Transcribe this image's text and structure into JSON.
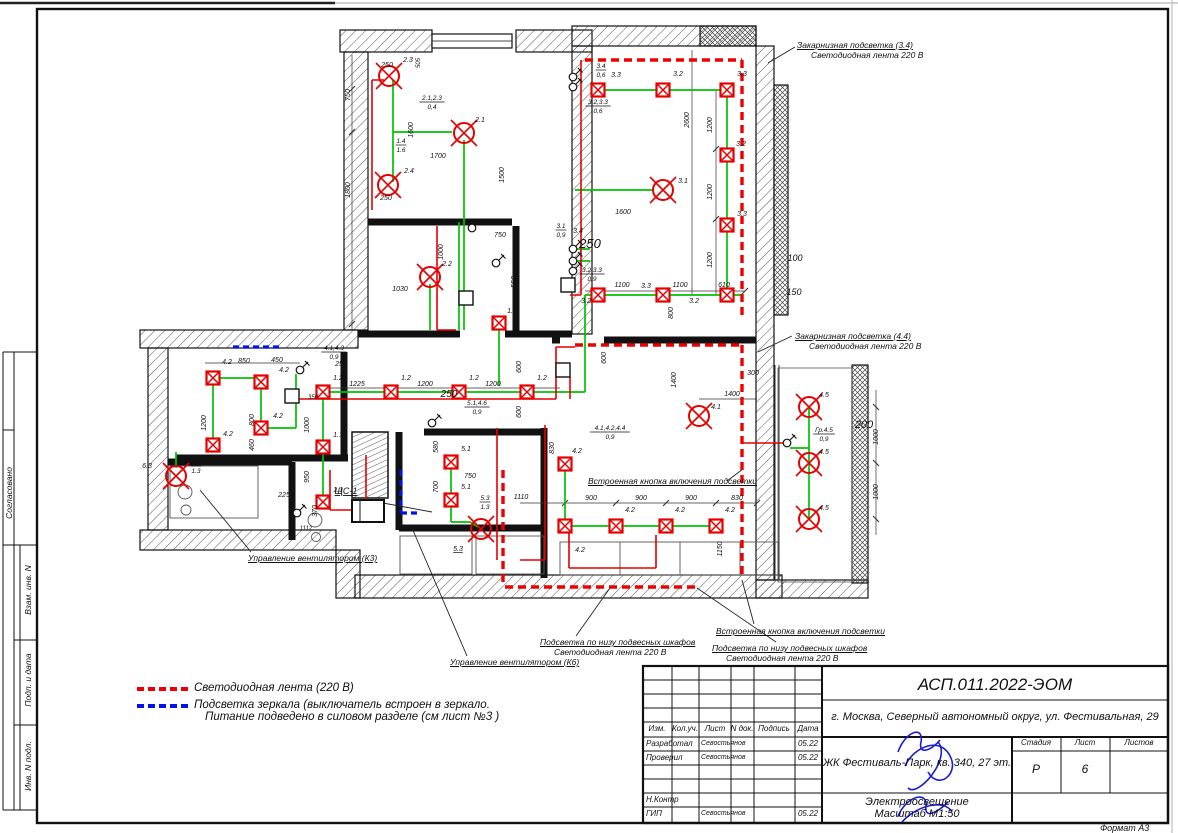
{
  "page": {
    "format_label": "Формат А3"
  },
  "colors": {
    "wire_green": "#00c300",
    "wire_red": "#e60000",
    "led_red": "#ee0000",
    "mirror_blue": "#0014e6",
    "signature_blue": "#1b1bd6"
  },
  "sidebar": {
    "items": [
      "Согласовано",
      "Взам. инв. N",
      "Подп. и дата",
      "Инв. N подл."
    ]
  },
  "legend": {
    "line1": "Светодиодная лента (220 В)",
    "line2": "Подсветка зеркала (выключатель встроен в зеркало.",
    "line3": "Питание подведено в силовом разделе (см лист №3 )"
  },
  "titleblock": {
    "doc_number": "АСП.011.2022-ЭОМ",
    "address": "г. Москва, Северный автономный округ, ул. Фестивальная, 29",
    "object": "ЖК Фестиваль-Парк, кв. 340, 27 эт.",
    "title_line1": "Электроосвещение",
    "title_line2": "Масштаб М1:50",
    "col_izm": "Изм.",
    "col_koluch": "Кол.уч.",
    "col_list": "Лист",
    "col_ndok": "N док.",
    "col_podpis": "Подпись",
    "col_data": "Дата",
    "stage_label": "Стадия",
    "sheet_label": "Лист",
    "sheets_label": "Листов",
    "stage": "Р",
    "sheet": "6",
    "sheets": "",
    "rows": [
      {
        "role": "Разработал",
        "name": "Севостьянов",
        "date": "05.22"
      },
      {
        "role": "Проверил",
        "name": "Севостьянов",
        "date": "05.22"
      },
      {
        "role": "",
        "name": "",
        "date": ""
      },
      {
        "role": "",
        "name": "",
        "date": ""
      },
      {
        "role": "Н.Контр",
        "name": "",
        "date": ""
      },
      {
        "role": "ГИП",
        "name": "Севостьянов",
        "date": "05.22"
      }
    ]
  },
  "plan": {
    "labels": [
      [
        "750",
        350,
        95,
        1
      ],
      [
        "250",
        387,
        67
      ],
      [
        "2.3",
        408,
        62
      ],
      [
        "505",
        420,
        63,
        1,
        6
      ],
      [
        "1800",
        350,
        190,
        1
      ],
      [
        "1600",
        413,
        130,
        1
      ],
      [
        "2.1",
        480,
        122
      ],
      [
        "1700",
        438,
        158
      ],
      [
        "1500",
        504,
        175,
        1
      ],
      [
        "2.4",
        409,
        173
      ],
      [
        "250",
        386,
        200
      ],
      [
        "2.2",
        447,
        266
      ],
      [
        "1000",
        443,
        252,
        1
      ],
      [
        "1030",
        400,
        291
      ],
      [
        "750",
        500,
        237
      ],
      [
        "550",
        516,
        282,
        1
      ],
      [
        "3.3",
        616,
        77
      ],
      [
        "3.2",
        678,
        76
      ],
      [
        "3.3",
        742,
        76
      ],
      [
        "2600",
        689,
        120,
        1
      ],
      [
        "1200",
        712,
        125,
        1
      ],
      [
        "3.2",
        741,
        146
      ],
      [
        "1200",
        712,
        192,
        1
      ],
      [
        "3.3",
        742,
        216
      ],
      [
        "3.1",
        683,
        183
      ],
      [
        "1600",
        623,
        214
      ],
      [
        "1200",
        712,
        260,
        1
      ],
      [
        "3.4",
        578,
        233
      ],
      [
        "250",
        590,
        248,
        0,
        13
      ],
      [
        "1100",
        622,
        287
      ],
      [
        "3.3",
        646,
        288
      ],
      [
        "1100",
        680,
        287
      ],
      [
        "610",
        724,
        287
      ],
      [
        "3.2",
        586,
        303
      ],
      [
        "3.2",
        694,
        303
      ],
      [
        "800",
        673,
        313,
        1
      ],
      [
        "100",
        795,
        261,
        0,
        9
      ],
      [
        "150",
        794,
        295,
        0,
        9
      ],
      [
        "250",
        341,
        366
      ],
      [
        "1.2",
        338,
        380
      ],
      [
        "1.2",
        406,
        380
      ],
      [
        "1.2",
        474,
        380
      ],
      [
        "1.2",
        542,
        380
      ],
      [
        "1225",
        357,
        386
      ],
      [
        "1200",
        425,
        386
      ],
      [
        "1200",
        493,
        386
      ],
      [
        "1.2",
        512,
        313
      ],
      [
        "350",
        313,
        399,
        0,
        6
      ],
      [
        "1000",
        309,
        425,
        1
      ],
      [
        "950",
        309,
        477,
        1
      ],
      [
        "1.1",
        338,
        437
      ],
      [
        "1.1",
        338,
        492
      ],
      [
        "600",
        521,
        367,
        1
      ],
      [
        "600",
        521,
        412,
        1
      ],
      [
        "250",
        449,
        397,
        0,
        10
      ],
      [
        "4.2",
        227,
        364
      ],
      [
        "850",
        244,
        363
      ],
      [
        "450",
        277,
        362
      ],
      [
        "4.2",
        284,
        372
      ],
      [
        "1200",
        206,
        423,
        1
      ],
      [
        "800",
        254,
        420,
        1
      ],
      [
        "4.2",
        278,
        418
      ],
      [
        "460",
        254,
        445,
        1
      ],
      [
        "4.2",
        228,
        436
      ],
      [
        "6.3",
        147,
        468
      ],
      [
        "225",
        284,
        497
      ],
      [
        "370",
        317,
        511,
        1
      ],
      [
        "1112",
        306,
        530,
        0,
        6
      ],
      [
        "580",
        438,
        447,
        1
      ],
      [
        "5.1",
        466,
        451
      ],
      [
        "700",
        438,
        487,
        1
      ],
      [
        "750",
        470,
        478
      ],
      [
        "5.1",
        466,
        489
      ],
      [
        "5.3",
        458,
        551,
        0,
        7,
        1
      ],
      [
        "4.2",
        577,
        453
      ],
      [
        "830",
        554,
        448,
        1
      ],
      [
        "600",
        606,
        358,
        1
      ],
      [
        "1400",
        676,
        380,
        1
      ],
      [
        "4.1",
        716,
        409
      ],
      [
        "1400",
        732,
        396
      ],
      [
        "300",
        753,
        375
      ],
      [
        "1110",
        521,
        499
      ],
      [
        "900",
        591,
        500
      ],
      [
        "900",
        641,
        500
      ],
      [
        "900",
        691,
        500
      ],
      [
        "830",
        737,
        500
      ],
      [
        "4.2",
        630,
        512
      ],
      [
        "4.2",
        680,
        512
      ],
      [
        "4.2",
        730,
        512
      ],
      [
        "4.2",
        580,
        552
      ],
      [
        "1150",
        722,
        549,
        1
      ],
      [
        "4.5",
        824,
        397
      ],
      [
        "4.5",
        824,
        454
      ],
      [
        "4.5",
        824,
        510
      ],
      [
        "200",
        864,
        428,
        0,
        11
      ],
      [
        "1000",
        878,
        437,
        1
      ],
      [
        "1000",
        878,
        492,
        1
      ],
      [
        "ЩС-1",
        346,
        494,
        0,
        9,
        1
      ]
    ],
    "fractions": [
      [
        "2.1,2.3",
        "0,4",
        432,
        100
      ],
      [
        "1.4",
        "1.6",
        401,
        143
      ],
      [
        "3.4",
        "0,6",
        601,
        68
      ],
      [
        "3.2,3.3",
        "0,6",
        598,
        104
      ],
      [
        "3.1",
        "0,9",
        561,
        228
      ],
      [
        "3.2,3.3",
        "0,9",
        592,
        272
      ],
      [
        "4.1,4.3",
        "0,9",
        334,
        350
      ],
      [
        "5.1,4.6",
        "0,9",
        477,
        405
      ],
      [
        "6.3",
        "1.3",
        196,
        464
      ],
      [
        "5.3",
        "1.3",
        485,
        500
      ],
      [
        "4.1,4.2,4.4",
        "0,9",
        610,
        430
      ],
      [
        "Гр.4.5",
        "0,9",
        824,
        432
      ]
    ],
    "lights_sq": [
      [
        598,
        90
      ],
      [
        663,
        90
      ],
      [
        727,
        90
      ],
      [
        727,
        155
      ],
      [
        727,
        225
      ],
      [
        598,
        295
      ],
      [
        663,
        295
      ],
      [
        727,
        295
      ],
      [
        499,
        323
      ],
      [
        323,
        392
      ],
      [
        391,
        392
      ],
      [
        459,
        392
      ],
      [
        527,
        392
      ],
      [
        323,
        447
      ],
      [
        323,
        502
      ],
      [
        213,
        378
      ],
      [
        261,
        382
      ],
      [
        261,
        428
      ],
      [
        213,
        445
      ],
      [
        451,
        462
      ],
      [
        451,
        500
      ],
      [
        565,
        464
      ],
      [
        565,
        526
      ],
      [
        616,
        526
      ],
      [
        666,
        526
      ],
      [
        716,
        526
      ]
    ],
    "lights_circ": [
      [
        389,
        76
      ],
      [
        464,
        133
      ],
      [
        388,
        185
      ],
      [
        430,
        277
      ],
      [
        663,
        190
      ],
      [
        699,
        416
      ],
      [
        176,
        476
      ],
      [
        481,
        529
      ],
      [
        809,
        407
      ],
      [
        809,
        463
      ],
      [
        809,
        519
      ]
    ],
    "switches": [
      [
        573,
        77
      ],
      [
        573,
        87
      ],
      [
        573,
        249
      ],
      [
        573,
        261
      ],
      [
        573,
        271
      ],
      [
        300,
        370
      ],
      [
        472,
        228
      ],
      [
        496,
        263
      ],
      [
        432,
        423
      ],
      [
        787,
        443
      ],
      [
        297,
        513
      ]
    ],
    "jboxes": [
      [
        568,
        285
      ],
      [
        563,
        370
      ],
      [
        466,
        298
      ],
      [
        292,
        396
      ]
    ],
    "panel": {
      "x": 352,
      "y": 500,
      "w": 32,
      "h": 22
    },
    "annotations": [
      {
        "x": 797,
        "y": 40,
        "lines": [
          "Закарнизная подсветка (3.4)",
          "Светодиодная лента 220 В"
        ]
      },
      {
        "x": 795,
        "y": 331,
        "lines": [
          "Закарнизная подсветка (4.4)",
          "Светодиодная лента 220 В"
        ]
      },
      {
        "x": 588,
        "y": 476,
        "lines": [
          "Встроенная кнопка включения подсветки"
        ]
      },
      {
        "x": 716,
        "y": 626,
        "lines": [
          "Встроенная кнопка включения подсветки"
        ]
      },
      {
        "x": 540,
        "y": 637,
        "lines": [
          "Подсветка по низу подвесных шкафов",
          "Светодиодная лента 220 В"
        ]
      },
      {
        "x": 712,
        "y": 643,
        "lines": [
          "Подсветка по низу подвесных шкафов",
          "Светодиодная лента 220 В"
        ]
      },
      {
        "x": 450,
        "y": 657,
        "lines": [
          "Управление вентилятором (К6)"
        ]
      },
      {
        "x": 248,
        "y": 553,
        "lines": [
          "Управление вентилятором (К3)"
        ]
      }
    ]
  }
}
